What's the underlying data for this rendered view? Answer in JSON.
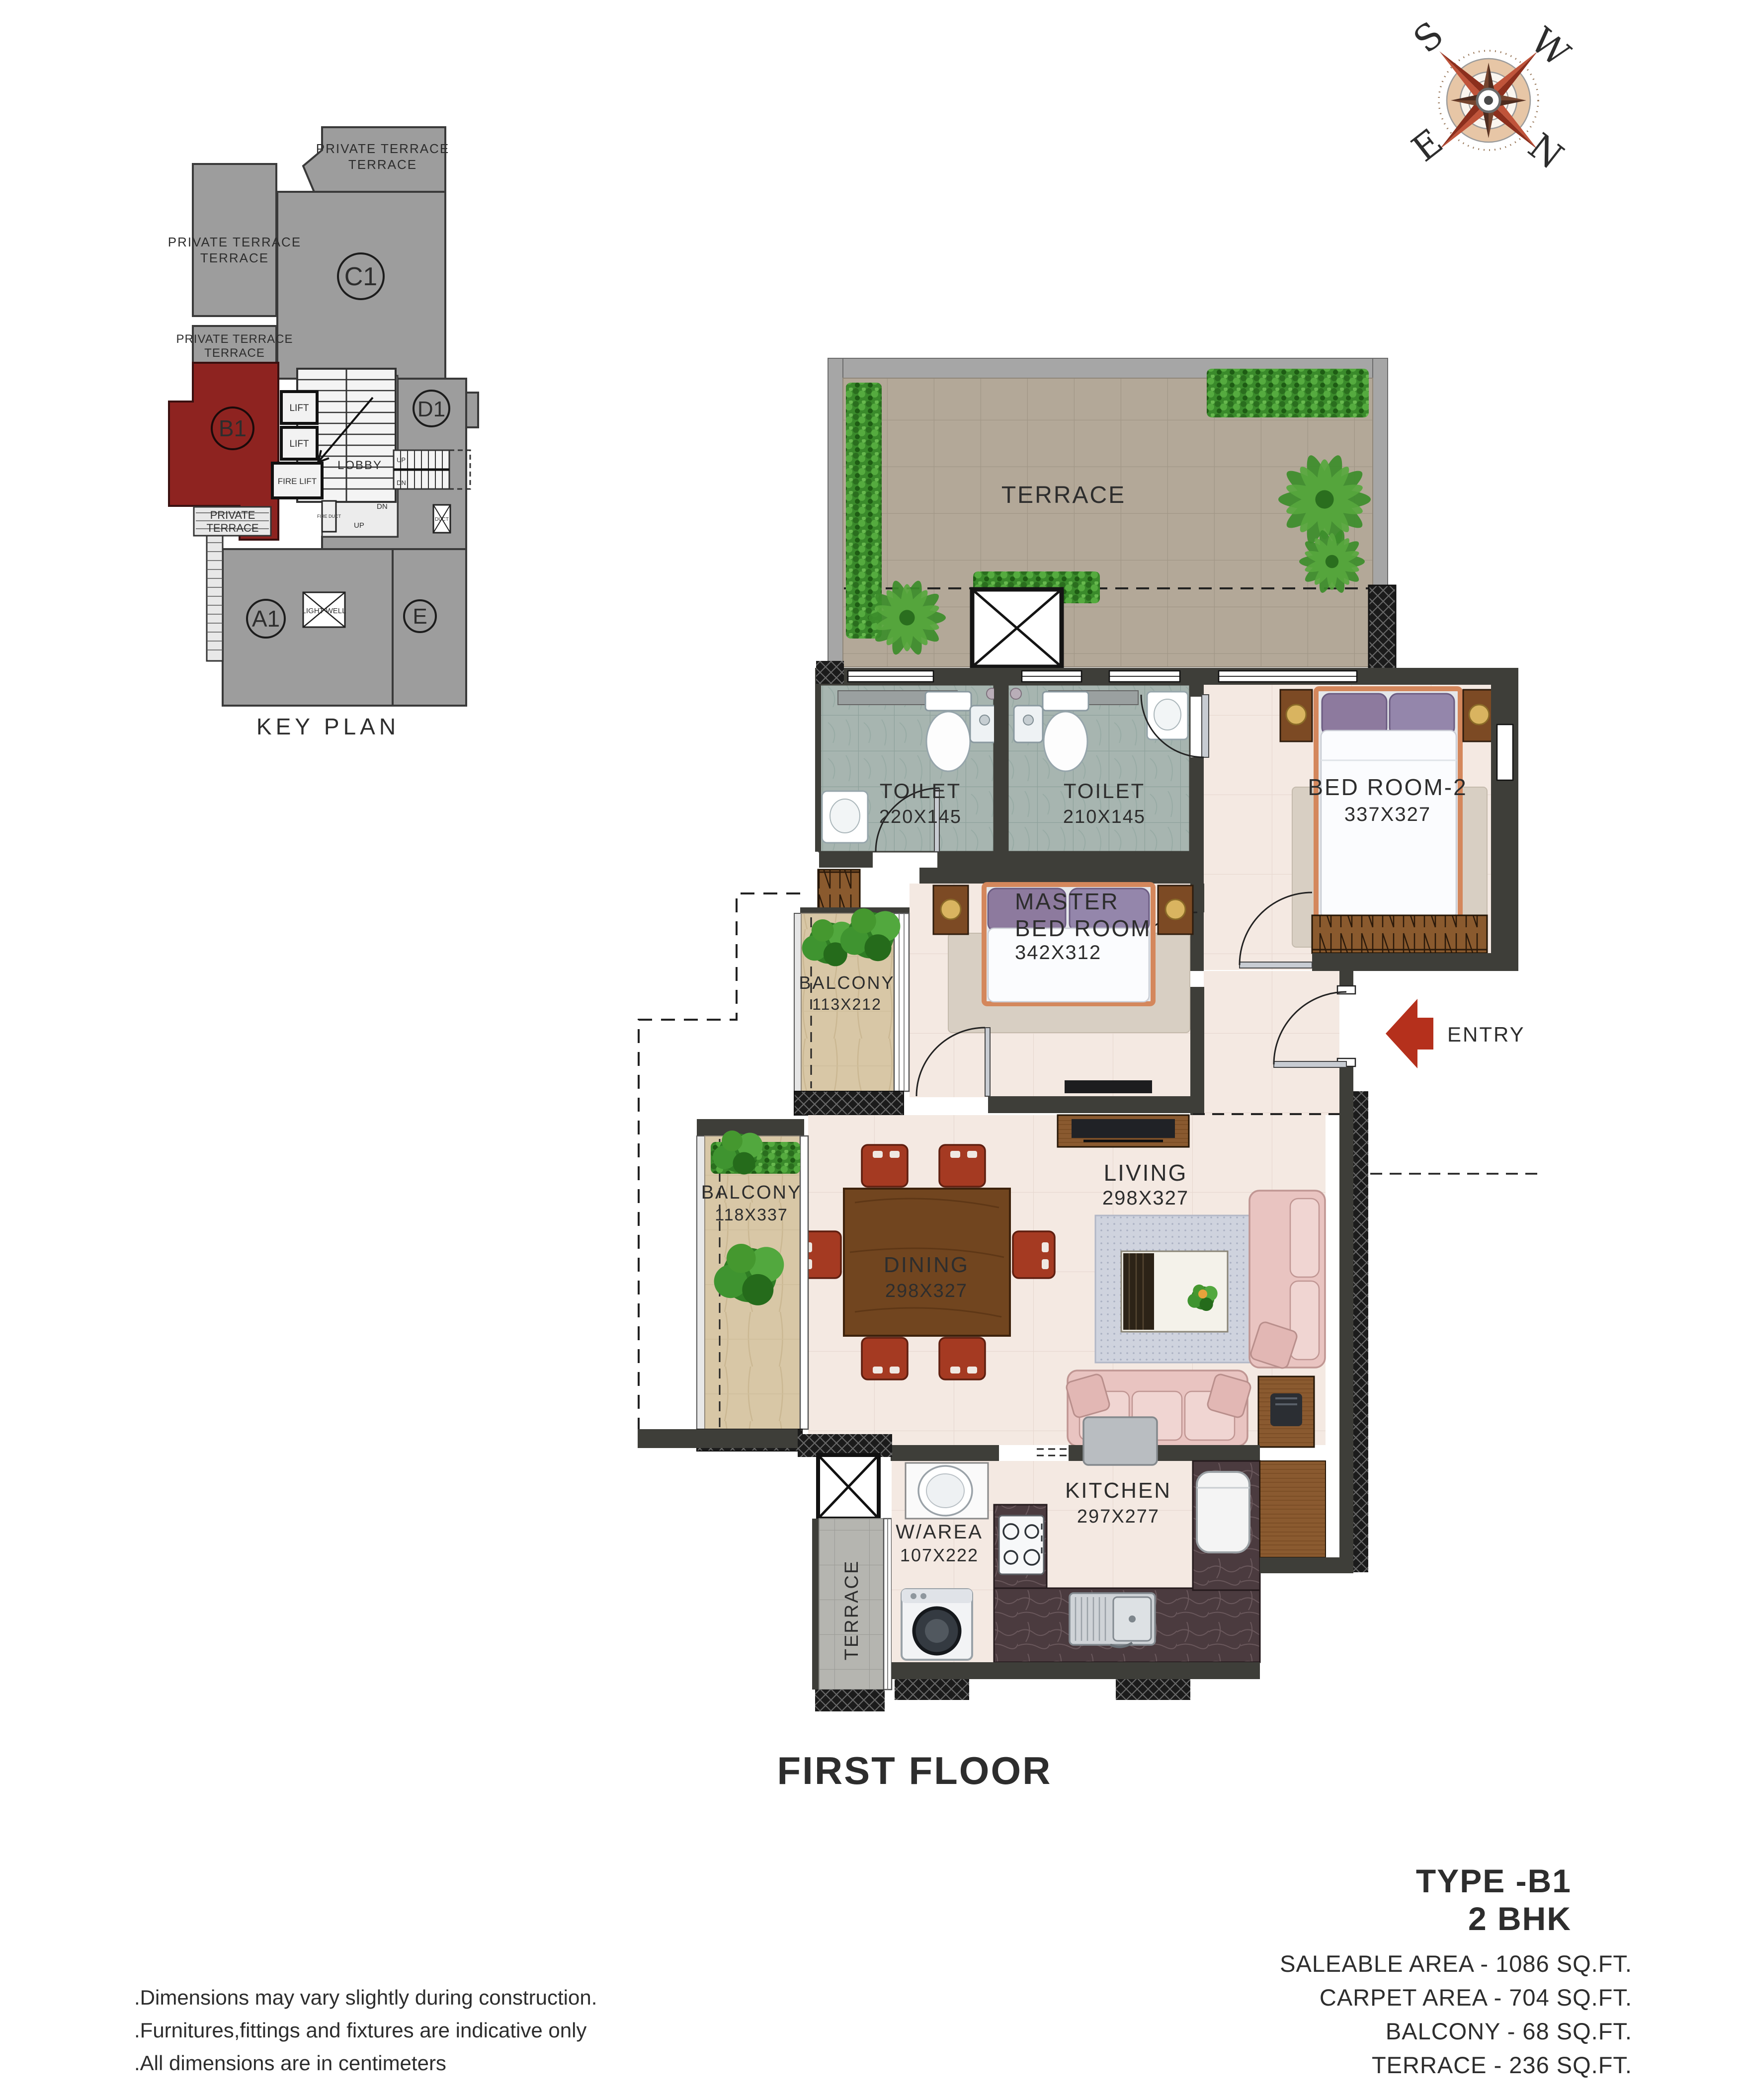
{
  "compass": {
    "s": "S",
    "w": "W",
    "e": "E",
    "n": "N"
  },
  "key_plan": {
    "title": "KEY PLAN",
    "units": {
      "c1": "C1",
      "d1": "D1",
      "b1": "B1",
      "a1": "A1",
      "e": "E"
    },
    "private_terrace_1": "PRIVATE TERRACE",
    "private_terrace_2": "PRIVATE TERRACE",
    "private_terrace_3": "PRIVATE TERRACE",
    "lift_1": "LIFT",
    "lift_2": "LIFT",
    "fire_lift": "FIRE LIFT",
    "lobby": "LOBBY",
    "light_well": "LIGHT WELL",
    "up": "UP",
    "dn": "DN",
    "fire_duct": "FIRE DUCT",
    "duct": "DUCT",
    "highlight_color": "#8e2320"
  },
  "plan": {
    "terrace": {
      "name": "TERRACE"
    },
    "toilet_1": {
      "name": "TOILET",
      "dims": "220X145"
    },
    "toilet_2": {
      "name": "TOILET",
      "dims": "210X145"
    },
    "bedroom_2": {
      "name": "BED ROOM-2",
      "dims": "337X327"
    },
    "master_bedroom": {
      "line1": "MASTER",
      "line2": "BED ROOM",
      "dims": "342X312"
    },
    "balcony_1": {
      "name": "BALCONY",
      "dims": "113X212"
    },
    "balcony_2": {
      "name": "BALCONY",
      "dims": "118X337"
    },
    "living": {
      "name": "LIVING",
      "dims": "298X327"
    },
    "dining": {
      "name": "DINING",
      "dims": "298X327"
    },
    "w_area": {
      "name": "W/AREA",
      "dims": "107X222"
    },
    "kitchen": {
      "name": "KITCHEN",
      "dims": "297X277"
    },
    "terrace_strip": {
      "name": "TERRACE"
    },
    "entry": {
      "name": "ENTRY",
      "arrow_color": "#b5301c"
    }
  },
  "footer": {
    "floor_title": "FIRST FLOOR",
    "type_line1": "TYPE -B1",
    "type_line2": "2 BHK",
    "area_lines": [
      "SALEABLE AREA - 1086 SQ.FT.",
      "CARPET AREA - 704 SQ.FT.",
      "BALCONY - 68 SQ.FT.",
      "TERRACE - 236 SQ.FT."
    ],
    "notes": [
      ".Dimensions may vary slightly during construction.",
      ".Furnitures,fittings and fixtures are indicative only",
      ".All dimensions are in centimeters"
    ]
  }
}
